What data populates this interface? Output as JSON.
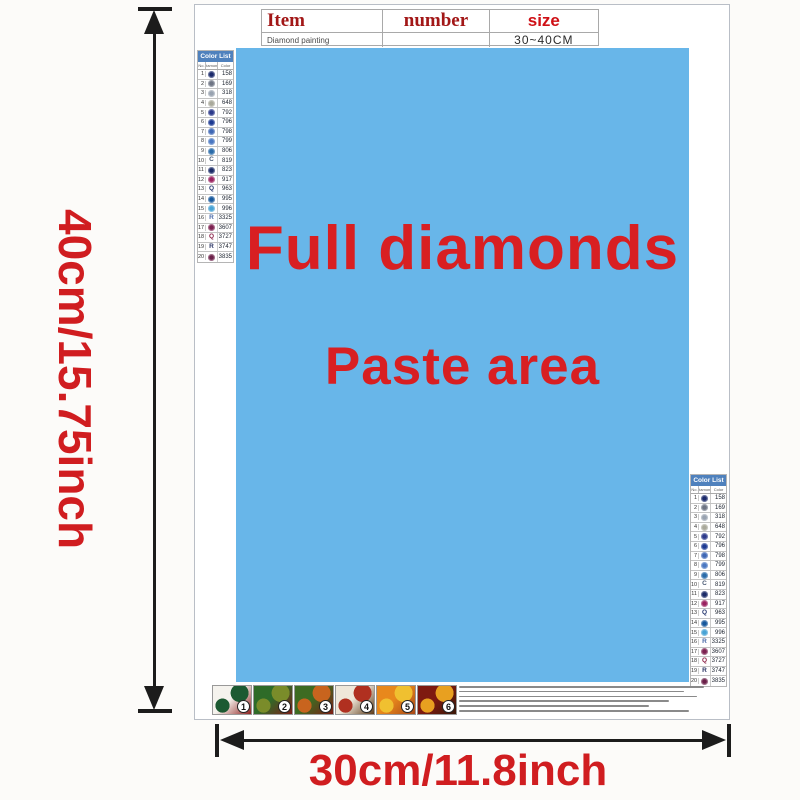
{
  "dimensions": {
    "height_label": "40cm/15.75inch",
    "width_label": "30cm/11.8inch"
  },
  "paste_area": {
    "line1": "Full diamonds",
    "line2": "Paste area",
    "background": "#68b6e9",
    "text_color": "#d81f22"
  },
  "item_table": {
    "headers": [
      "Item",
      "number",
      "size"
    ],
    "row": {
      "item": "Diamond painting",
      "number": "",
      "size": "30~40CM"
    }
  },
  "color_list": {
    "title": "Color List",
    "columns": [
      "No.",
      "Diamond",
      "Color"
    ],
    "header_bg": "#4f81bd",
    "rows": [
      {
        "no": "1",
        "symbol": "dot",
        "letter": "",
        "color": "#1b2a6b",
        "code": "158"
      },
      {
        "no": "2",
        "symbol": "dot",
        "letter": "",
        "color": "#6e7584",
        "code": "169"
      },
      {
        "no": "3",
        "symbol": "dot",
        "letter": "",
        "color": "#98a2b0",
        "code": "318"
      },
      {
        "no": "4",
        "symbol": "dot",
        "letter": "",
        "color": "#a9a99b",
        "code": "648"
      },
      {
        "no": "5",
        "symbol": "dot",
        "letter": "",
        "color": "#2c3a8b",
        "code": "792"
      },
      {
        "no": "6",
        "symbol": "dot",
        "letter": "",
        "color": "#1d3a92",
        "code": "796"
      },
      {
        "no": "7",
        "symbol": "dot",
        "letter": "",
        "color": "#3f68b5",
        "code": "798"
      },
      {
        "no": "8",
        "symbol": "dot",
        "letter": "",
        "color": "#4a78c2",
        "code": "799"
      },
      {
        "no": "9",
        "symbol": "dot",
        "letter": "",
        "color": "#2a6ba9",
        "code": "806"
      },
      {
        "no": "10",
        "symbol": "letter",
        "letter": "C",
        "color": "#4a5a74",
        "code": "819"
      },
      {
        "no": "11",
        "symbol": "dot",
        "letter": "",
        "color": "#1b2b68",
        "code": "823"
      },
      {
        "no": "12",
        "symbol": "dot",
        "letter": "",
        "color": "#9a2260",
        "code": "917"
      },
      {
        "no": "13",
        "symbol": "letter",
        "letter": "Q",
        "color": "#23356e",
        "code": "963"
      },
      {
        "no": "14",
        "symbol": "dot",
        "letter": "",
        "color": "#17589c",
        "code": "995"
      },
      {
        "no": "15",
        "symbol": "dot",
        "letter": "",
        "color": "#48a3d5",
        "code": "996"
      },
      {
        "no": "16",
        "symbol": "letter",
        "letter": "R",
        "color": "#4a6aa8",
        "code": "3325"
      },
      {
        "no": "17",
        "symbol": "dot",
        "letter": "",
        "color": "#7c2050",
        "code": "3607"
      },
      {
        "no": "18",
        "symbol": "letter",
        "letter": "Q",
        "color": "#8a2046",
        "code": "3727"
      },
      {
        "no": "19",
        "symbol": "letter",
        "letter": "R",
        "color": "#2a3464",
        "code": "3747"
      },
      {
        "no": "20",
        "symbol": "dot",
        "letter": "",
        "color": "#6b2049",
        "code": "3835"
      }
    ]
  },
  "thumbnails": [
    {
      "number": "1",
      "colors": [
        "#f5f3ee",
        "#1c5a32",
        "#8e1f1e"
      ]
    },
    {
      "number": "2",
      "colors": [
        "#2e6b28",
        "#7a8c2a",
        "#7e1f1a"
      ]
    },
    {
      "number": "3",
      "colors": [
        "#3d6b22",
        "#c8641e",
        "#7e1c14"
      ]
    },
    {
      "number": "4",
      "colors": [
        "#efe8da",
        "#b03020",
        "#5c3a1a"
      ]
    },
    {
      "number": "5",
      "colors": [
        "#e8881c",
        "#f0c030",
        "#a84818"
      ]
    },
    {
      "number": "6",
      "colors": [
        "#7e1a10",
        "#e8a020",
        "#3a1808"
      ]
    }
  ],
  "colors": {
    "dimension_text": "#d01d20",
    "arrow": "#1c1c1c",
    "table_header_red": "#a21717",
    "size_red": "#cf1016"
  }
}
